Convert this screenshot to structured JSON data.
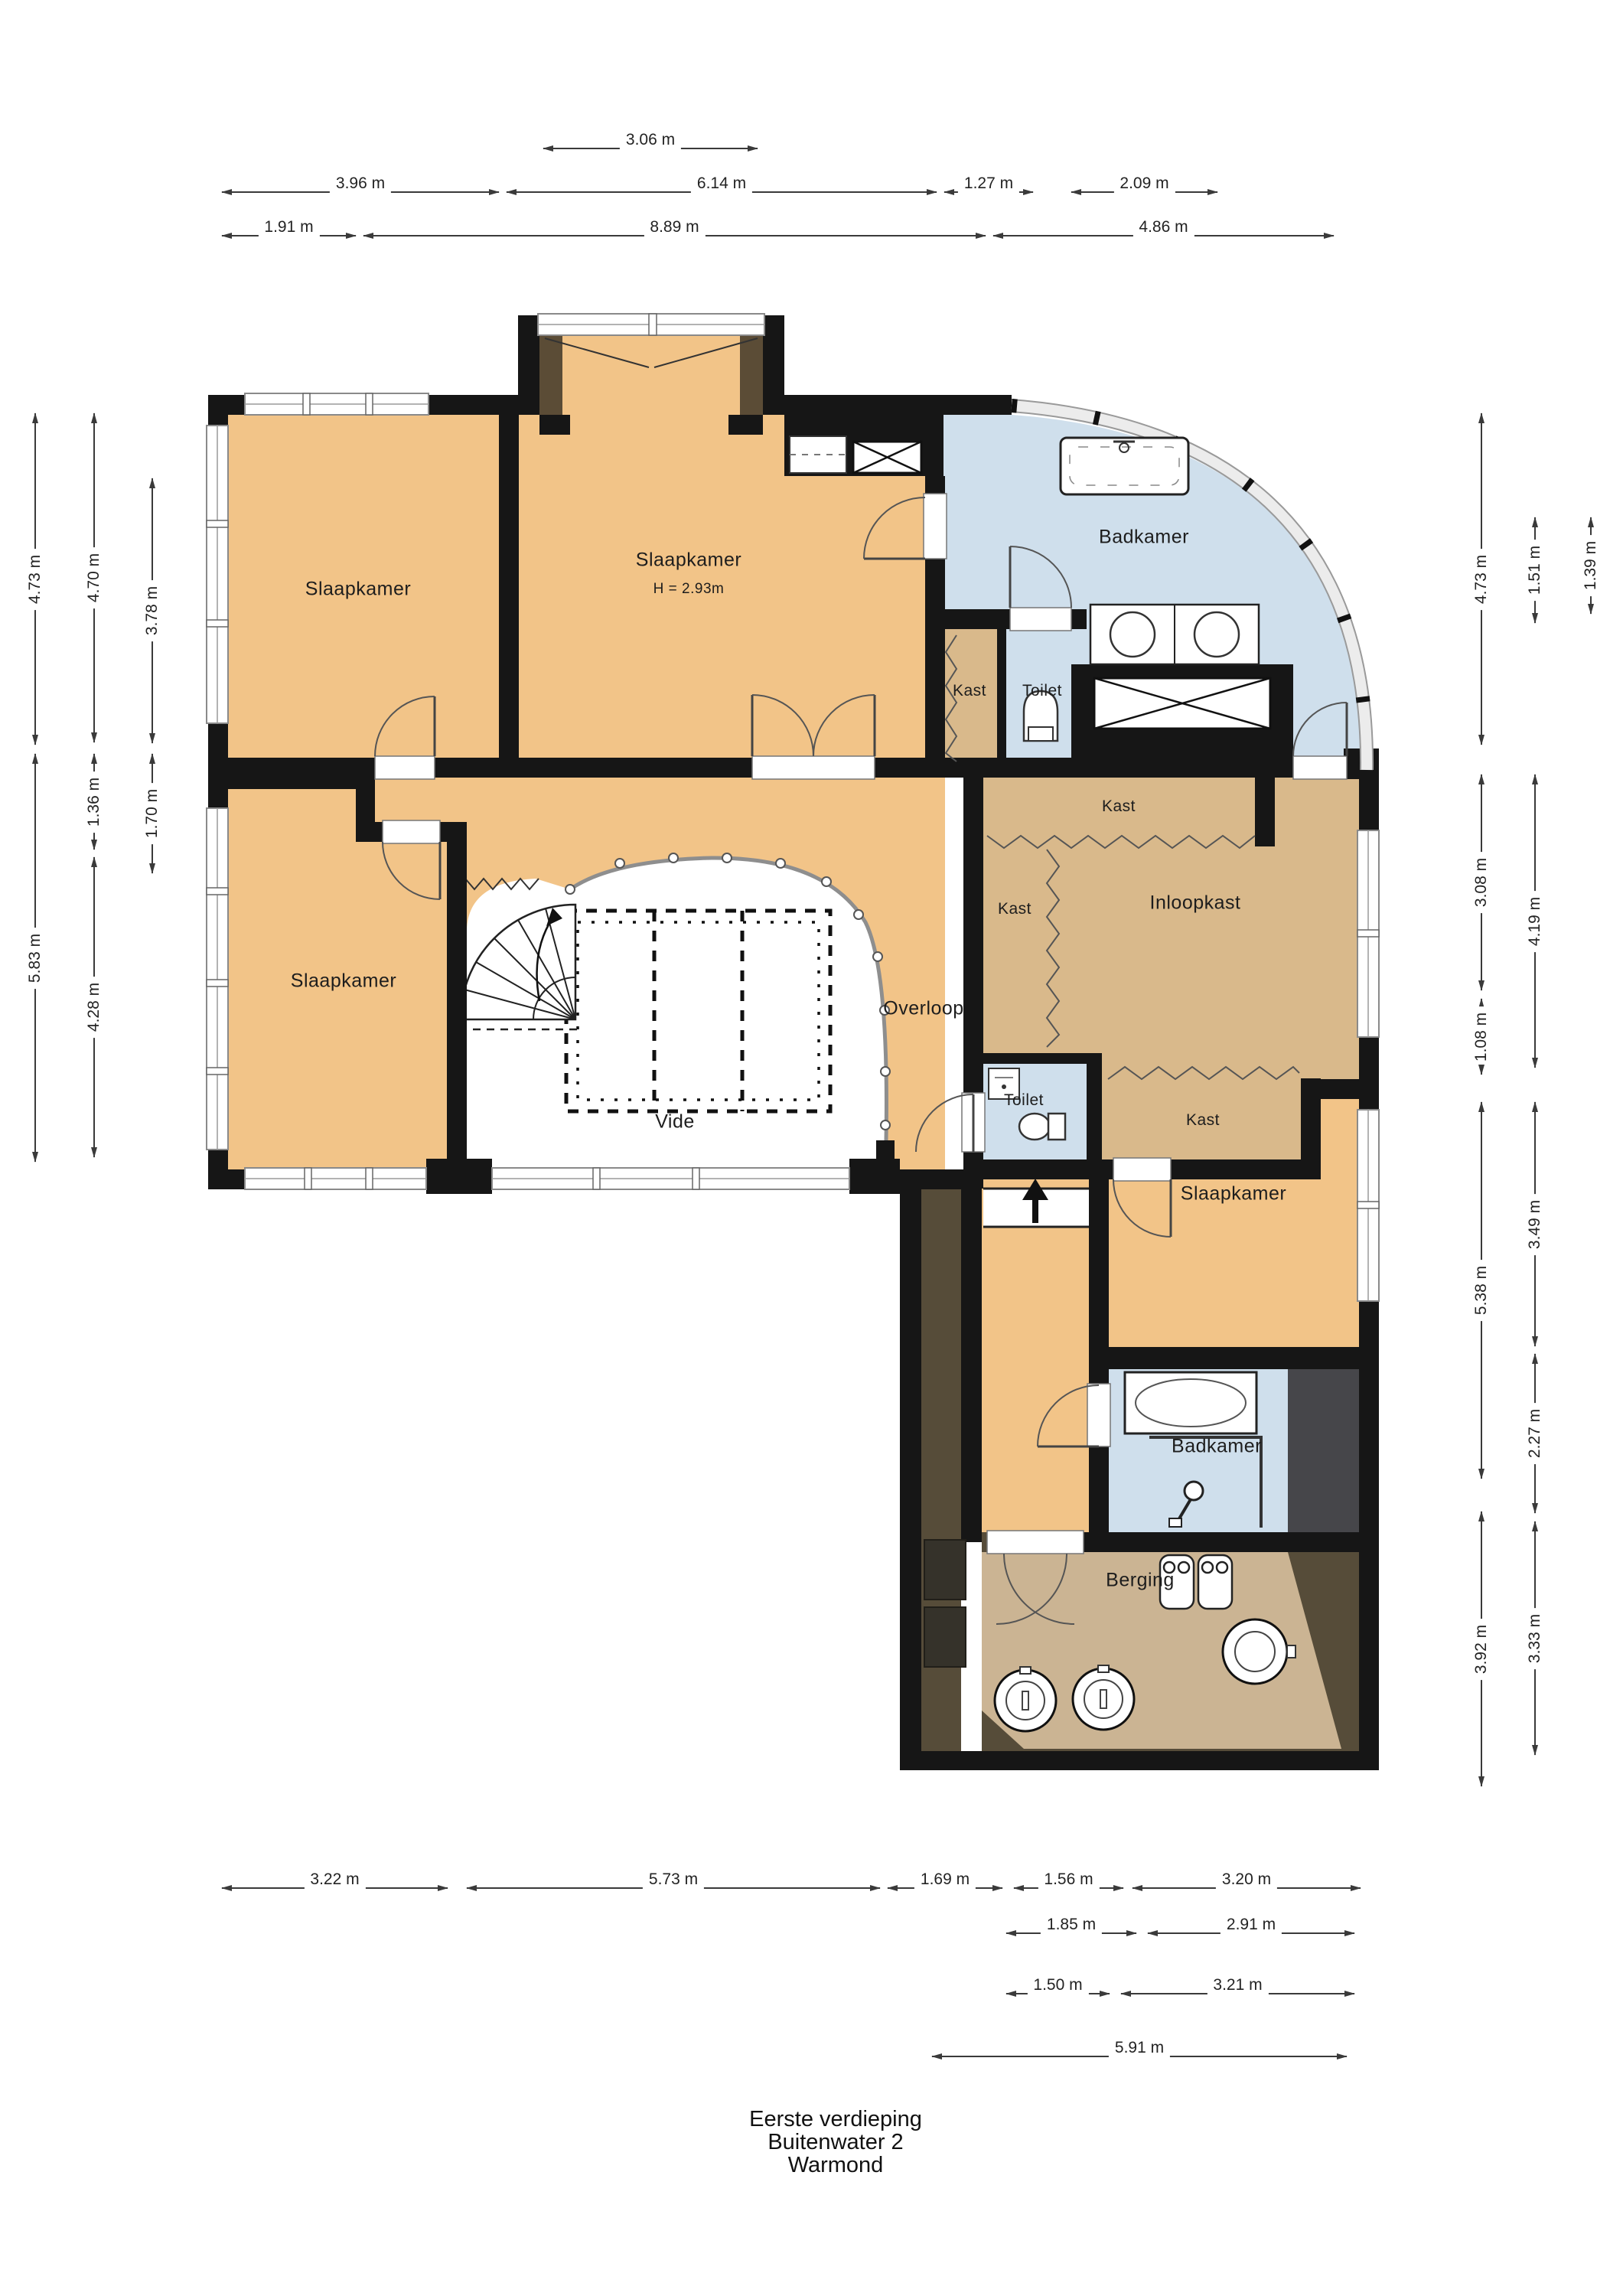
{
  "title": {
    "line1": "Eerste verdieping",
    "line2": "Buitenwater 2",
    "line3": "Warmond"
  },
  "rooms": {
    "slaapkamer_tl": "Slaapkamer",
    "slaapkamer_tm": "Slaapkamer",
    "slaapkamer_tm_height": "H = 2.93m",
    "badkamer_top": "Badkamer",
    "kast_top": "Kast",
    "toilet_top": "Toilet",
    "kast_inloop_top": "Kast",
    "kast_inloop_left": "Kast",
    "inloopkast": "Inloopkast",
    "overloop": "Overloop",
    "toilet_mid": "Toilet",
    "kast_inloop_bottom": "Kast",
    "slaapkamer_bl": "Slaapkamer",
    "vide": "Vide",
    "slaapkamer_r": "Slaapkamer",
    "badkamer_bottom": "Badkamer",
    "berging": "Berging"
  },
  "dims": {
    "top_row1": [
      "3.06 m"
    ],
    "top_row2": [
      "3.96 m",
      "6.14 m",
      "1.27 m",
      "2.09 m"
    ],
    "top_row3": [
      "1.91 m",
      "8.89 m",
      "4.86 m"
    ],
    "bottom_row1": [
      "3.22 m",
      "5.73 m",
      "1.69 m",
      "1.56 m",
      "3.20 m"
    ],
    "bottom_row2": [
      "1.85 m",
      "2.91 m"
    ],
    "bottom_row3": [
      "1.50 m",
      "3.21 m"
    ],
    "bottom_row4": [
      "5.91 m"
    ],
    "left_col1": [
      "4.73 m",
      "5.83 m"
    ],
    "left_col2": [
      "4.70 m",
      "1.36 m",
      "4.28 m"
    ],
    "left_col3": [
      "3.78 m",
      "1.70 m"
    ],
    "right_col1": [
      "4.73 m",
      "3.08 m",
      "1.08 m",
      "5.38 m",
      "3.92 m"
    ],
    "right_col2": [
      "1.51 m",
      "4.19 m",
      "3.49 m",
      "2.27 m",
      "3.33 m"
    ],
    "right_col3": [
      "1.39 m"
    ]
  },
  "colors": {
    "floor_orange": "#f2c488",
    "floor_tan": "#d9b98b",
    "floor_berging": "#cbb493",
    "bathroom_blue": "#cfdfec",
    "wall_black": "#161616",
    "roof_olive": "#564c39",
    "shaft_gray": "#46464a",
    "dim_line": "#3a3a3a"
  }
}
